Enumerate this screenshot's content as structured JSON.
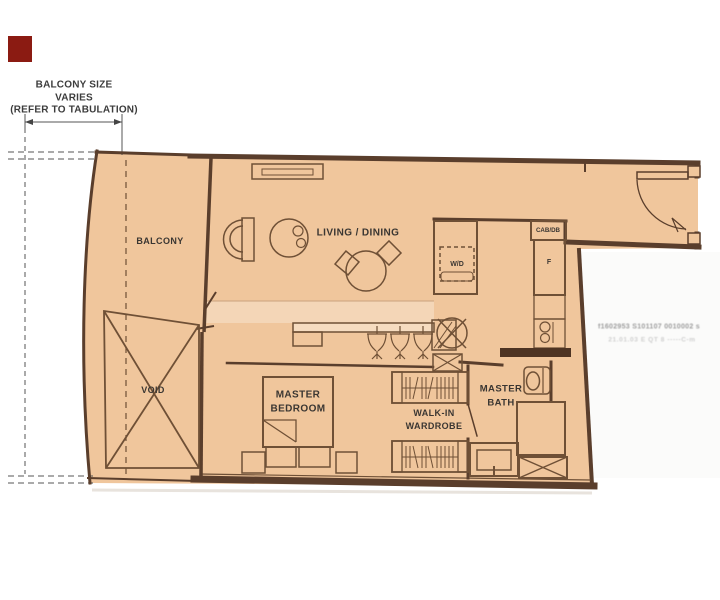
{
  "annotation": {
    "balcony_size_note": "BALCONY SIZE\nVARIES\n(REFER TO TABULATION)"
  },
  "rooms": {
    "balcony": "BALCONY",
    "void": "VOID",
    "living_dining": "LIVING / DINING",
    "master_bedroom": "MASTER\nBEDROOM",
    "walk_in_wardrobe": "WALK-IN\nWARDROBE",
    "master_bath": "MASTER\nBATH"
  },
  "fixtures": {
    "cabinet_db": "CAB/DB",
    "washer_dryer": "W/D",
    "fridge": "F"
  },
  "watermark": {
    "line1": "f1602953 S101107 0010002  s",
    "line2": "21.01.03 E QT 8 -----C-m"
  },
  "colors": {
    "plan_fill": "#f0c69c",
    "wall": "#5a3e2c",
    "line": "#6f5036",
    "text": "#3a3632",
    "red_marker": "#8b1b12",
    "watermark": "#9d9d9d"
  }
}
